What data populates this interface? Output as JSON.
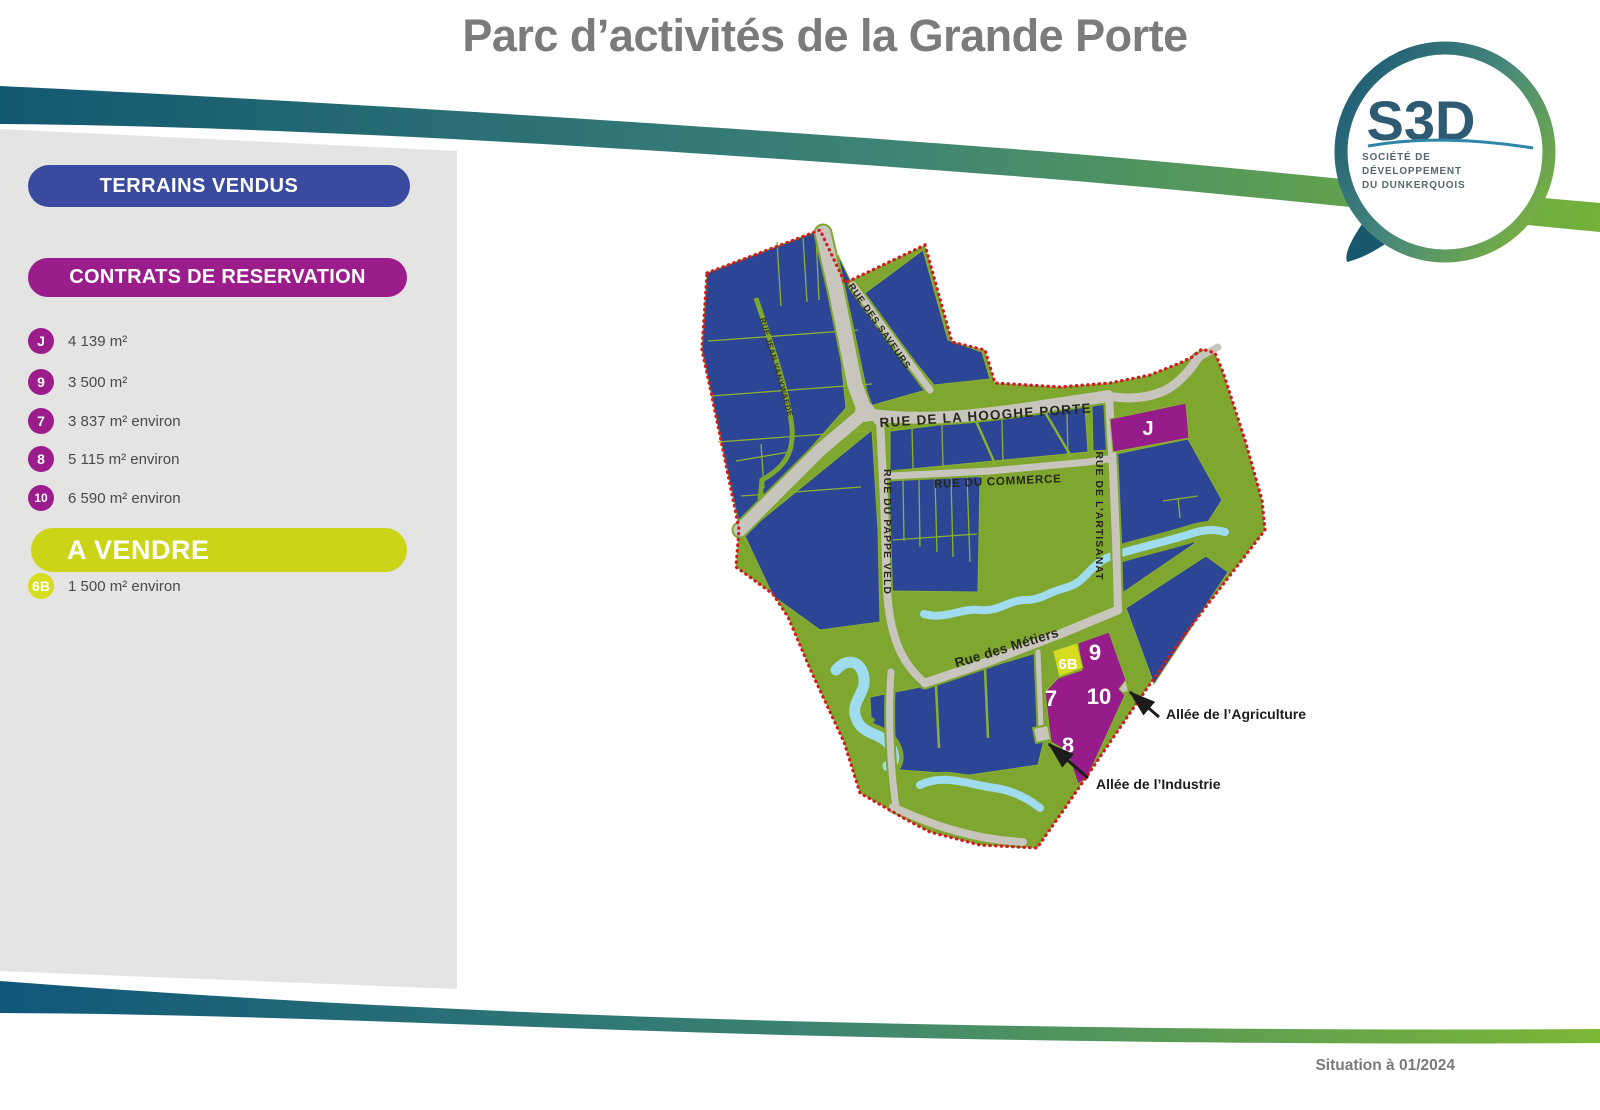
{
  "title": "Parc d’activités de la Grande Porte",
  "logo": {
    "acronym": "S3D",
    "org_lines": [
      "SOCIÉTÉ DE",
      "DÉVELOPPEMENT",
      "DU DUNKERQUOIS"
    ]
  },
  "legend": {
    "sold_banner": "TERRAINS VENDUS",
    "reservation_banner": "CONTRATS DE RESERVATION",
    "reservation_items": [
      {
        "id": "J",
        "area": "4 139 m²"
      },
      {
        "id": "9",
        "area": "3 500 m²"
      },
      {
        "id": "7",
        "area": "3 837 m² environ"
      },
      {
        "id": "8",
        "area": "5 115 m² environ"
      },
      {
        "id": "10",
        "area": "6 590 m² environ"
      }
    ],
    "sale_banner": "A VENDRE",
    "sale_items": [
      {
        "id": "6B",
        "area": "1 500 m² environ"
      }
    ]
  },
  "map": {
    "streets": {
      "hooghe_porte": "RUE DE LA HOOGHE PORTE",
      "commerce": "RUE DU COMMERCE",
      "pappeveld": "RUE DU PAPPE VELD",
      "artisanat": "RUE DE L’ARTISANAT",
      "saveurs": "RUE DES SAVEURS",
      "jean_vanywaede": "RUE JEAN VANYWAEDE",
      "metiers": "Rue des Métiers"
    },
    "plots": {
      "j": "J",
      "p6b": "6B",
      "p7": "7",
      "p8": "8",
      "p9": "9",
      "p10": "10"
    },
    "callouts": {
      "agriculture": "Allée de l’Agriculture",
      "industrie": "Allée de l’Industrie"
    }
  },
  "footer": {
    "status": "Situation à 01/2024"
  },
  "colors": {
    "sold_blue": "#3a4b9f",
    "reservation_purple": "#9b1d8c",
    "sale_yellow": "#ccd418",
    "parcel_blue": "#2c4595",
    "landscape_green": "#7fa62e",
    "road_gray": "#c8c5bd",
    "water_blue": "#9fdcf0",
    "boundary_red": "#ce1e24",
    "band_teal": "#135871",
    "band_green": "#76b23a"
  }
}
